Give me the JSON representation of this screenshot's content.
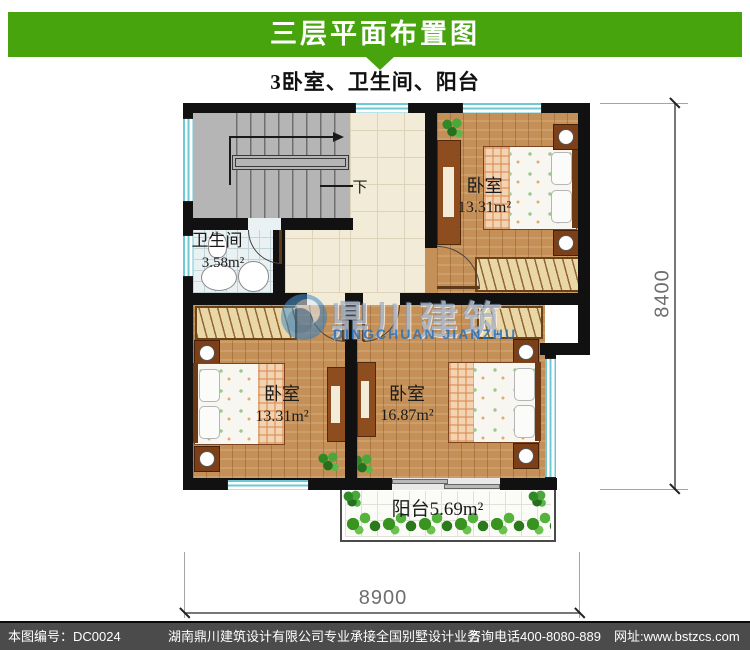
{
  "header": {
    "title": "三层平面布置图",
    "subtitle": "3卧室、卫生间、阳台",
    "bar_color": "#48a40c"
  },
  "rooms": {
    "bedroom_top_right": {
      "label": "卧室",
      "area": "13.31m²"
    },
    "bathroom": {
      "label": "卫生间",
      "area": "3.58m²"
    },
    "bedroom_bottom_left": {
      "label": "卧室",
      "area": "13.31m²"
    },
    "bedroom_bottom_right": {
      "label": "卧室",
      "area": "16.87m²"
    },
    "balcony": {
      "label": "阳台5.69m²"
    },
    "stairs_down_label": "下"
  },
  "dimensions": {
    "right": "8400",
    "bottom": "8900"
  },
  "watermark": {
    "cn": "鼎川建筑",
    "en": "DINGCHUAN JIANZHU"
  },
  "footer": {
    "drawing_no": "本图编号：DC0024",
    "company": "湖南鼎川建筑设计有限公司专业承接全国别墅设计业务",
    "phone": "咨询电话400-8080-889",
    "website": "网址:www.bstzcs.com",
    "bg": "#4b4b4b"
  }
}
